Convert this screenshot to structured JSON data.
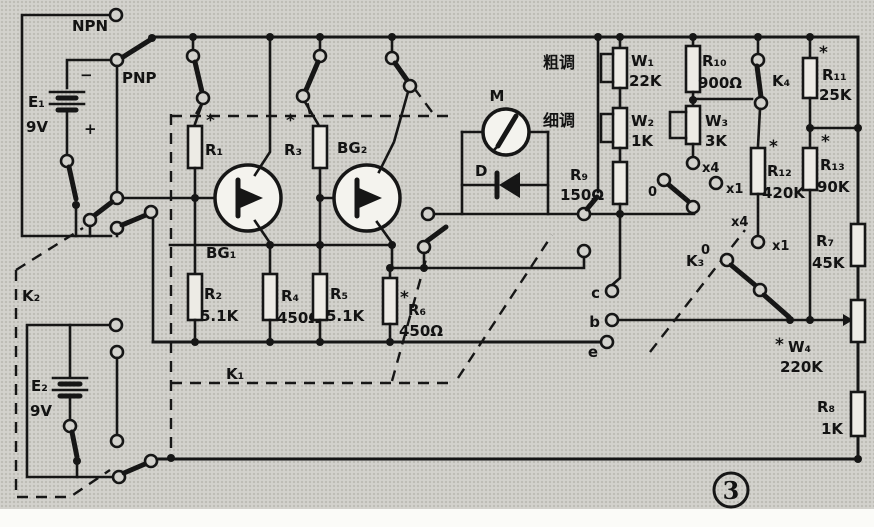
{
  "figure": {
    "number": "3"
  },
  "power": {
    "npn_label": "NPN",
    "pnp_label": "PNP",
    "e1": {
      "name": "E₁",
      "voltage": "9V",
      "minus": "−",
      "plus": "+"
    },
    "e2": {
      "name": "E₂",
      "voltage": "9V"
    },
    "k2_label": "K₂"
  },
  "transistors": {
    "bg1": "BG₁",
    "bg2": "BG₂"
  },
  "resistors": {
    "r1": {
      "star": "*",
      "name": "R₁"
    },
    "r2": {
      "name": "R₂",
      "value": "5.1K"
    },
    "r3": {
      "star": "*",
      "name": "R₃"
    },
    "r4": {
      "name": "R₄",
      "value": "450Ω"
    },
    "r5": {
      "name": "R₅",
      "value": "5.1K"
    },
    "r6": {
      "star": "*",
      "name": "R₆",
      "value": "450Ω"
    },
    "r7": {
      "name": "R₇",
      "value": "45K"
    },
    "r8": {
      "name": "R₈",
      "value": "1K"
    },
    "r9": {
      "name": "R₉",
      "value": "150Ω"
    },
    "r10": {
      "name": "R₁₀",
      "value": "900Ω"
    },
    "r11": {
      "star": "*",
      "name": "R₁₁",
      "value": "25K"
    },
    "r12": {
      "star": "*",
      "name": "R₁₂",
      "value": "420K"
    },
    "r13": {
      "star": "*",
      "name": "R₁₃",
      "value": "90K"
    }
  },
  "potentiometers": {
    "w1": {
      "name": "W₁",
      "value": "22K",
      "caption": "粗调"
    },
    "w2": {
      "name": "W₂",
      "value": "1K",
      "caption": "细调"
    },
    "w3": {
      "name": "W₃",
      "value": "3K"
    },
    "w4": {
      "star": "*",
      "name": "W₄",
      "value": "220K"
    }
  },
  "meter": {
    "name": "M"
  },
  "diode": {
    "name": "D"
  },
  "switches": {
    "k1": "K₁",
    "k3": "K₃",
    "k4": "K₄"
  },
  "range_taps": {
    "upper": {
      "zero": "0",
      "x4": "x4",
      "x1": "x1"
    },
    "lower": {
      "zero": "0",
      "x4": "x4",
      "x1": "x1"
    }
  },
  "terminals": {
    "c": "c",
    "b": "b",
    "e": "e"
  }
}
